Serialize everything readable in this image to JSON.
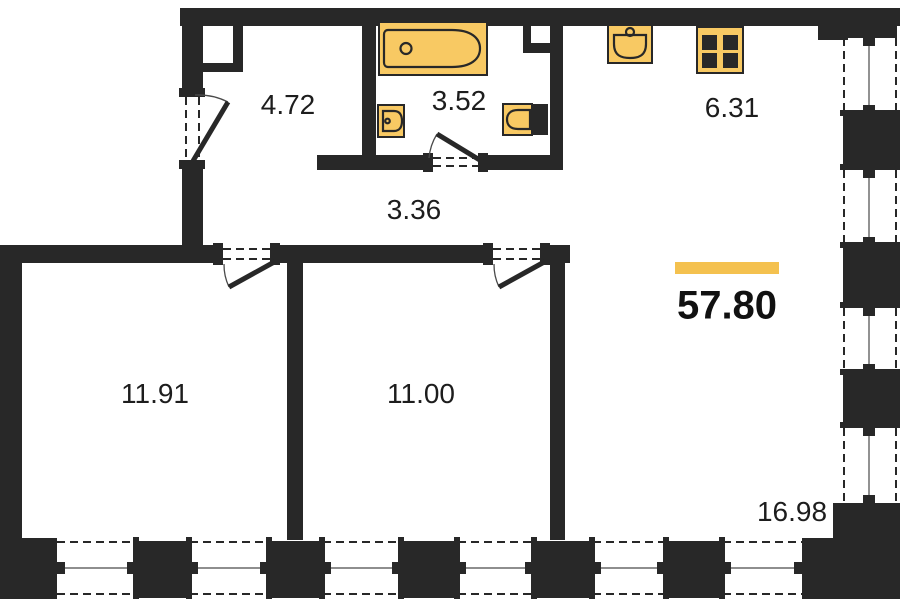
{
  "plan": {
    "total_area": "57.80",
    "rooms": [
      {
        "id": "hallway",
        "area": "4.72"
      },
      {
        "id": "bathroom",
        "area": "3.52"
      },
      {
        "id": "kitchen",
        "area": "6.31"
      },
      {
        "id": "corridor",
        "area": "3.36"
      },
      {
        "id": "bedroom-1",
        "area": "11.91"
      },
      {
        "id": "bedroom-2",
        "area": "11.00"
      },
      {
        "id": "living-room",
        "area": "16.98"
      }
    ],
    "fixtures": [
      "bathtub",
      "washbasin",
      "toilet",
      "kitchen-sink",
      "stove"
    ],
    "colors": {
      "wall": "#282828",
      "fixture_fill": "#F8C963",
      "accent": "#F4C14F",
      "background": "#ffffff"
    }
  }
}
